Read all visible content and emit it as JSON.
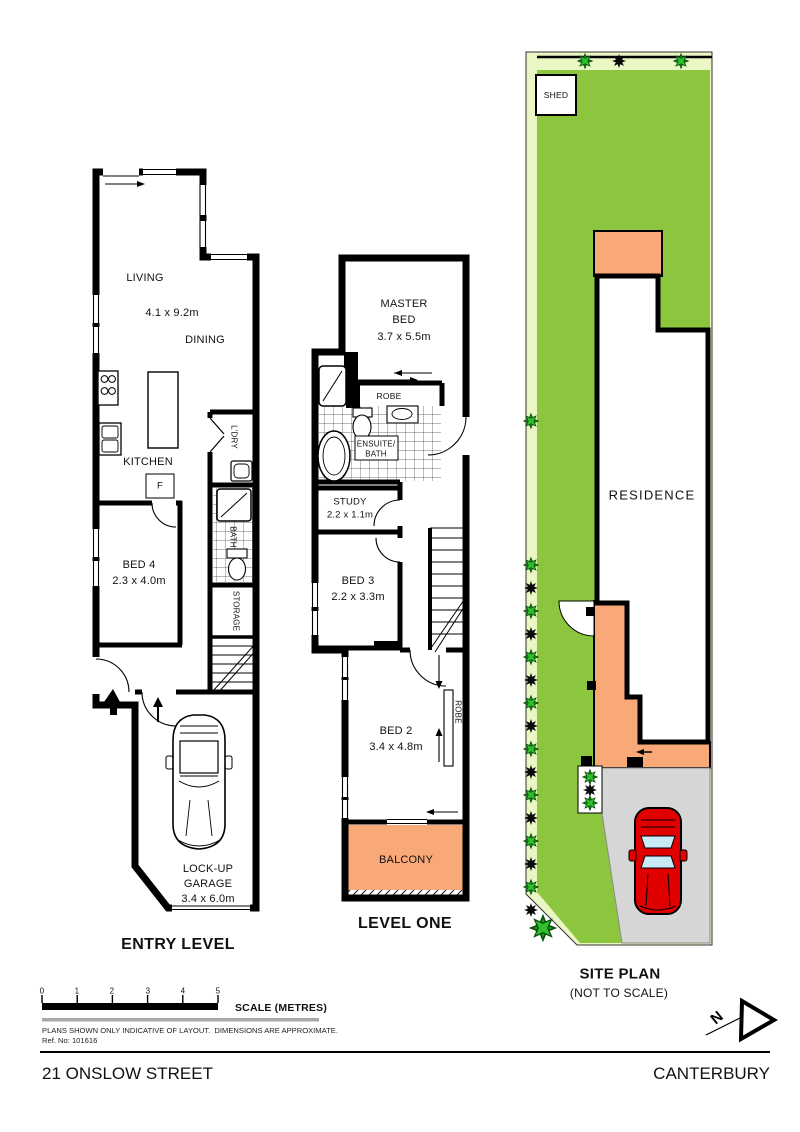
{
  "plans": {
    "entry": {
      "title": "ENTRY LEVEL",
      "rooms": {
        "living": "LIVING",
        "living_dims": "4.1 x 9.2m",
        "dining": "DINING",
        "kitchen": "KITCHEN",
        "fridge": "F",
        "laundry": "L'DRY",
        "bath": "BATH",
        "storage": "STORAGE",
        "bed4": "BED 4",
        "bed4_dims": "2.3 x 4.0m",
        "garage_line1": "LOCK-UP",
        "garage_line2": "GARAGE",
        "garage_dims": "3.4 x 6.0m"
      }
    },
    "level_one": {
      "title": "LEVEL ONE",
      "rooms": {
        "master_line1": "MASTER",
        "master_line2": "BED",
        "master_dims": "3.7 x 5.5m",
        "robe": "ROBE",
        "ensuite_line1": "ENSUITE/",
        "ensuite_line2": "BATH",
        "study": "STUDY",
        "study_dims": "2.2 x 1.1m",
        "bed3": "BED 3",
        "bed3_dims": "2.2 x 3.3m",
        "bed2": "BED 2",
        "bed2_dims": "3.4 x 4.8m",
        "robe2": "ROBE",
        "balcony": "BALCONY"
      }
    },
    "site": {
      "title": "SITE PLAN",
      "subtitle": "(NOT TO SCALE)",
      "shed": "SHED",
      "residence": "RESIDENCE"
    }
  },
  "scale_bar": {
    "ticks": [
      "0",
      "1",
      "2",
      "3",
      "4",
      "5"
    ],
    "label": "SCALE (METRES)"
  },
  "notes": {
    "disclaimer": "PLANS SHOWN ONLY INDICATIVE OF LAYOUT.  DIMENSIONS ARE APPROXIMATE.",
    "reference": "Ref. No: 101616"
  },
  "footer": {
    "street": "21 ONSLOW STREET",
    "suburb": "CANTERBURY"
  },
  "icons": {
    "north_letter": "N",
    "north_arrow": "north-arrow",
    "plant_green": "shrub-icon",
    "plant_dark": "shrub-icon-dark",
    "site_car": "red-car-top-view",
    "garage_car": "car-outline-top-view"
  },
  "colors": {
    "lawn": "#8CC63E",
    "lawn_light": "#EAF6C3",
    "deck": "#F9A878",
    "driveway": "#D6D6D6",
    "car": "#E00000",
    "glass": "#C9EAF7",
    "wall": "#000000"
  }
}
